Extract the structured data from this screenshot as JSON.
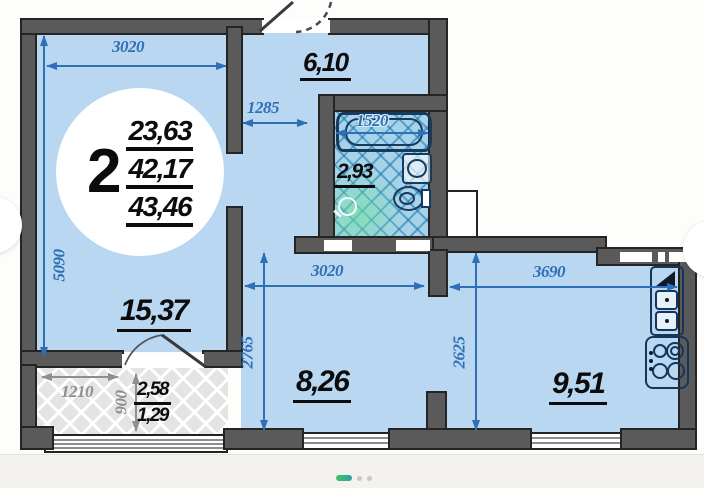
{
  "unit": {
    "rooms": "2",
    "areas": [
      "23,63",
      "42,17",
      "43,46"
    ]
  },
  "rooms": {
    "hall": "6,10",
    "bath": "2,93",
    "bedroom": "15,37",
    "living": "8,26",
    "kitchen": "9,51",
    "balcony_total": "2,58",
    "balcony_counted": "1,29"
  },
  "dims": {
    "bedroom_w": "3020",
    "bedroom_h": "5090",
    "hall_w": "1285",
    "bath_w": "1520",
    "living_w": "3020",
    "living_h": "2765",
    "kitchen_w": "3690",
    "kitchen_h": "2625",
    "balcony_w": "1210",
    "balcony_d": "900"
  },
  "carousel": {
    "prev_icon": "‹",
    "next_icon": "›",
    "dots_total": 3,
    "active_dot": 1
  },
  "colors": {
    "wall": "#5a5a5a",
    "room_fill": "#b9d7f1",
    "bath_tile": "#a7d3ea",
    "dim_blue": "#2f6fb5",
    "dim_gray": "#8f8f8f",
    "label_black": "#0c0c0c",
    "active_dot_gradient": [
      "#43c06c",
      "#2ba3a0"
    ]
  }
}
